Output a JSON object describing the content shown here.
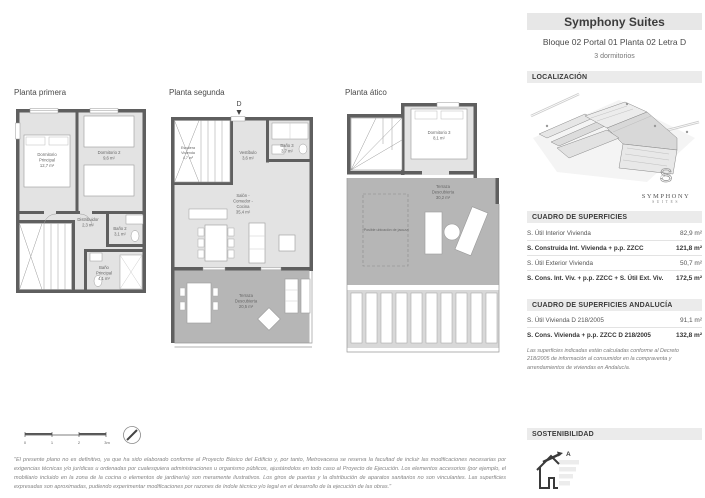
{
  "header": {
    "title": "Symphony Suites",
    "subtitle": "Bloque 02 Portal 01 Planta 02 Letra D",
    "bedrooms": "3 dormitorios"
  },
  "sidebar": {
    "localizacion_title": "LOCALIZACIÓN",
    "logo": {
      "name": "SYMPHONY",
      "sub": "SUITES",
      "monogram": "S"
    },
    "superficies_title": "CUADRO DE SUPERFICIES",
    "superficies_rows": [
      {
        "label": "S. Útil Interior Vivienda",
        "value": "82,9 m²"
      },
      {
        "label": "S. Construida Int. Vivienda + p.p. ZZCC",
        "value": "121,8 m²"
      },
      {
        "label": "S. Útil Exterior Vivienda",
        "value": "50,7 m²"
      },
      {
        "label": "S. Cons. Int. Viv. + p.p. ZZCC + S. Útil Ext. Viv.",
        "value": "172,5 m²"
      }
    ],
    "andalucia_title": "CUADRO DE SUPERFICIES ANDALUCÍA",
    "andalucia_rows": [
      {
        "label": "S. Útil Vivienda D 218/2005",
        "value": "91,1 m²"
      },
      {
        "label": "S. Cons. Vivienda + p.p. ZZCC D 218/2005",
        "value": "132,8 m²"
      }
    ],
    "andalucia_note": "Las superficies indicadas están calculadas conforme al Decreto 218/2005 de información al consumidor en la compraventa y arrendamientos de viviendas en Andalucía.",
    "sostenibilidad_title": "SOSTENIBILIDAD",
    "energy_rating": "A"
  },
  "plans": {
    "primera": {
      "title": "Planta primera",
      "dorm_principal": [
        "Dormitorio",
        "Principal",
        "12,7 m²"
      ],
      "dorm2": [
        "Dormitorio 2",
        "9,6 m²"
      ],
      "distribuidor": [
        "Distribuidor",
        "2,3 m²"
      ],
      "bano2": [
        "Baño 2",
        "3,1 m²"
      ],
      "bano_principal": [
        "Baño",
        "Principal",
        "4,1 m²"
      ]
    },
    "segunda": {
      "title": "Planta segunda",
      "marker": "D",
      "escalera": [
        "Escalera",
        "Vivienda",
        "4,7 m²"
      ],
      "vestibulo": [
        "Vestíbulo",
        "3,6 m²"
      ],
      "bano3": [
        "Baño 3",
        "3,7 m²"
      ],
      "salon": [
        "Salón -",
        "Comedor -",
        "Cocina",
        "35,4 m²"
      ],
      "terraza": [
        "Terraza",
        "Descubierta",
        "20,5 m²"
      ]
    },
    "atico": {
      "title": "Planta ático",
      "dorm3": [
        "Dormitorio 3",
        "8,1 m²"
      ],
      "terraza": [
        "Terraza",
        "Descubierta",
        "30,2 m²"
      ],
      "jacuzzi": "*Posible ubicación de jacuzzi"
    }
  },
  "scale_labels": [
    "0",
    "1",
    "2",
    "3m"
  ],
  "disclaimer": "\"El presente plano no es definitivo, ya que ha sido elaborado conforme al Proyecto Básico del Edificio y, por tanto, Metrovacesa se reserva la facultad de incluir las modificaciones necesarias por exigencias técnicas y/o jurídicas u ordenadas por cualesquiera administraciones u organismo públicos, ajustándolos en todo caso al Proyecto de Ejecución. Los elementos accesorios (por ejemplo, el mobiliario incluido en la zona de la cocina o elementos de jardinería) son meramente ilustrativos. Los giros de puertas y la distribución de aparatos sanitarios no son vinculantes. Las superficies expresadas son aproximadas, pudiendo experimentar modificaciones por razones de índole técnico y/o legal en el desarrollo de la ejecución de las obras.\""
}
